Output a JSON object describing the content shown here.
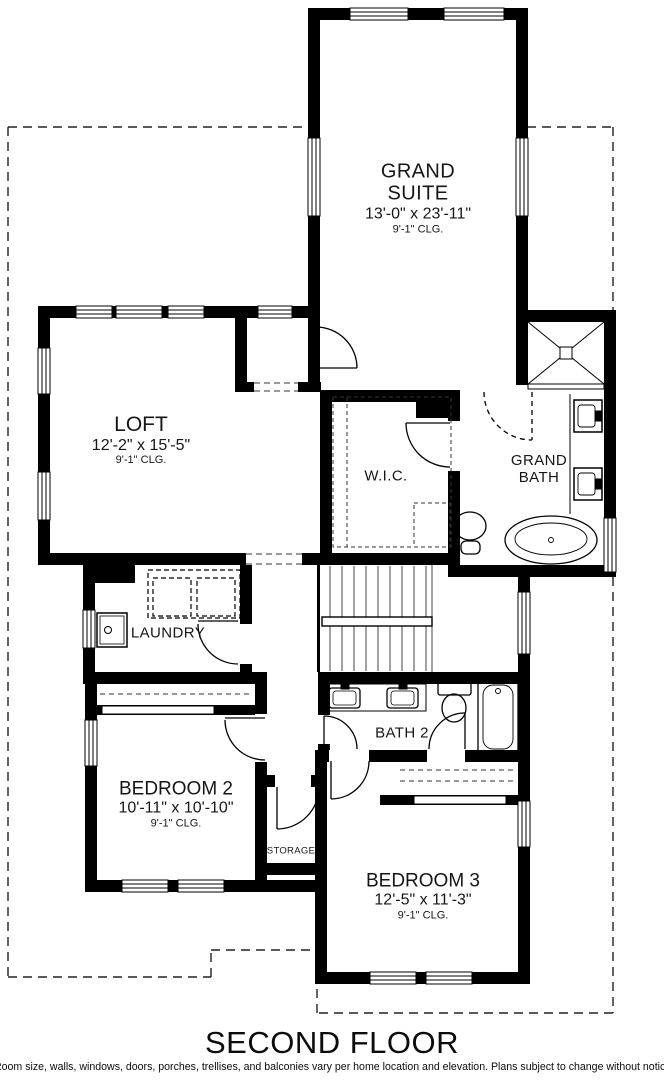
{
  "title": "SECOND FLOOR",
  "disclaimer": "*Room size, walls, windows, doors, porches, trellises, and balconies vary per home location and elevation. Plans subject to change without notice.",
  "colors": {
    "wall": "#000000",
    "background": "#ffffff",
    "line": "#333333"
  },
  "rooms": {
    "grand_suite": {
      "name_line1": "GRAND",
      "name_line2": "SUITE",
      "dims": "13'-0\" x 23'-11\"",
      "ceiling": "9'-1\" CLG."
    },
    "loft": {
      "name": "LOFT",
      "dims": "12'-2\" x 15'-5\"",
      "ceiling": "9'-1\" CLG."
    },
    "wic": {
      "name": "W.I.C."
    },
    "grand_bath": {
      "name_line1": "GRAND",
      "name_line2": "BATH"
    },
    "laundry": {
      "name": "LAUNDRY"
    },
    "bedroom2": {
      "name": "BEDROOM 2",
      "dims": "10'-11\" x 10'-10\"",
      "ceiling": "9'-1\" CLG."
    },
    "bath2": {
      "name": "BATH 2"
    },
    "storage": {
      "name": "STORAGE"
    },
    "bedroom3": {
      "name": "BEDROOM 3",
      "dims": "12'-5\" x 11'-3\"",
      "ceiling": "9'-1\" CLG."
    }
  }
}
